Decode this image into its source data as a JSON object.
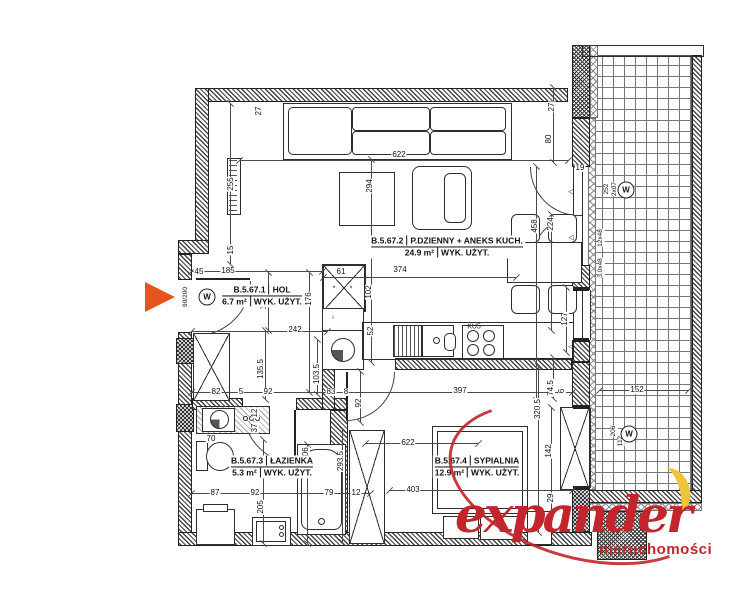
{
  "plan": {
    "rooms": [
      {
        "id": "B.5.67.1",
        "name": "HOL",
        "area": "6.7 m²",
        "usage": "WYK. UŻYT."
      },
      {
        "id": "B.5.67.2",
        "name": "P.DZIENNY + ANEKS KUCH.",
        "area": "24.9 m²",
        "usage": "WYK. UŻYT."
      },
      {
        "id": "B.5.67.3",
        "name": "ŁAZIENKA",
        "area": "5.3 m²",
        "usage": "WYK. UŻYT."
      },
      {
        "id": "B.5.67.4",
        "name": "SYPIALNIA",
        "area": "12.9 m²",
        "usage": "WYK. UŻYT."
      }
    ],
    "dimensions": [
      {
        "t": "27",
        "x": 259,
        "y": 111,
        "r": 1
      },
      {
        "t": "255",
        "x": 231,
        "y": 184,
        "r": 1
      },
      {
        "t": "15",
        "x": 231,
        "y": 250,
        "r": 1
      },
      {
        "t": "622",
        "x": 399,
        "y": 155
      },
      {
        "t": "294",
        "x": 370,
        "y": 186,
        "r": 1
      },
      {
        "t": "374",
        "x": 400,
        "y": 270
      },
      {
        "t": "45",
        "x": 199,
        "y": 272
      },
      {
        "t": "185",
        "x": 228,
        "y": 271
      },
      {
        "t": "104",
        "x": 264,
        "y": 303,
        "r": 1
      },
      {
        "t": "176",
        "x": 309,
        "y": 299,
        "r": 1
      },
      {
        "t": "242",
        "x": 295,
        "y": 330
      },
      {
        "t": "61",
        "x": 341,
        "y": 272
      },
      {
        "t": "102",
        "x": 369,
        "y": 292,
        "r": 1
      },
      {
        "t": "52",
        "x": 371,
        "y": 331,
        "r": 1
      },
      {
        "t": "458",
        "x": 535,
        "y": 226,
        "r": 1
      },
      {
        "t": "224",
        "x": 551,
        "y": 224,
        "r": 1
      },
      {
        "t": "27",
        "x": 552,
        "y": 107,
        "r": 1
      },
      {
        "t": "80",
        "x": 549,
        "y": 139,
        "r": 1
      },
      {
        "t": "19",
        "x": 580,
        "y": 168
      },
      {
        "t": "127",
        "x": 565,
        "y": 319,
        "r": 1
      },
      {
        "t": "92",
        "x": 359,
        "y": 403,
        "r": 1
      },
      {
        "t": "83",
        "x": 331,
        "y": 392
      },
      {
        "t": "8",
        "x": 346,
        "y": 392
      },
      {
        "t": "397",
        "x": 460,
        "y": 391
      },
      {
        "t": "74.5",
        "x": 551,
        "y": 388,
        "r": 1
      },
      {
        "t": "6",
        "x": 562,
        "y": 391,
        "r": 1
      },
      {
        "t": "135.5",
        "x": 261,
        "y": 369,
        "r": 1
      },
      {
        "t": "103.5",
        "x": 317,
        "y": 374,
        "r": 1
      },
      {
        "t": "82",
        "x": 216,
        "y": 392
      },
      {
        "t": "5",
        "x": 241,
        "y": 392
      },
      {
        "t": "92",
        "x": 268,
        "y": 392
      },
      {
        "t": "12",
        "x": 255,
        "y": 413,
        "r": 1
      },
      {
        "t": "37",
        "x": 255,
        "y": 428,
        "r": 1
      },
      {
        "t": "70",
        "x": 211,
        "y": 439
      },
      {
        "t": "206",
        "x": 306,
        "y": 454,
        "r": 1
      },
      {
        "t": "205",
        "x": 261,
        "y": 507,
        "r": 1
      },
      {
        "t": "87",
        "x": 215,
        "y": 493
      },
      {
        "t": "92",
        "x": 255,
        "y": 493
      },
      {
        "t": "79",
        "x": 329,
        "y": 493
      },
      {
        "t": "12",
        "x": 356,
        "y": 493
      },
      {
        "t": "293.5",
        "x": 341,
        "y": 461,
        "r": 1
      },
      {
        "t": "622",
        "x": 408,
        "y": 443
      },
      {
        "t": "403",
        "x": 413,
        "y": 490
      },
      {
        "t": "320.5",
        "x": 538,
        "y": 409,
        "r": 1
      },
      {
        "t": "142",
        "x": 549,
        "y": 451,
        "r": 1
      },
      {
        "t": "29",
        "x": 551,
        "y": 498,
        "r": 1
      },
      {
        "t": "152",
        "x": 637,
        "y": 390
      }
    ],
    "markers": [
      {
        "k": "vt",
        "t": "90/200",
        "x": 186,
        "y": 297
      },
      {
        "k": "circle",
        "t": "W",
        "x": 207,
        "y": 297
      },
      {
        "k": "vt",
        "t": "252",
        "x": 607,
        "y": 189
      },
      {
        "k": "vt",
        "t": "2x07",
        "x": 615,
        "y": 189
      },
      {
        "k": "circle",
        "t": "W",
        "x": 626,
        "y": 190
      },
      {
        "k": "vt",
        "t": "12x48",
        "x": 601,
        "y": 238
      },
      {
        "k": "vt",
        "t": "3.0x48",
        "x": 601,
        "y": 268
      },
      {
        "k": "vt",
        "t": "206",
        "x": 614,
        "y": 431
      },
      {
        "k": "vt",
        "t": "112",
        "x": 621,
        "y": 441
      },
      {
        "k": "circle",
        "t": "W",
        "x": 629,
        "y": 434
      },
      {
        "k": "ht",
        "t": "KU5",
        "x": 474,
        "y": 327
      },
      {
        "k": "ht",
        "t": "*",
        "x": 334,
        "y": 289
      },
      {
        "k": "ht",
        "t": "*",
        "x": 351,
        "y": 289
      },
      {
        "k": "ht",
        "t": "◁",
        "x": 571,
        "y": 192
      },
      {
        "k": "ht",
        "t": "◁",
        "x": 571,
        "y": 238
      },
      {
        "k": "ht",
        "t": "◁",
        "x": 571,
        "y": 347
      },
      {
        "k": "ht",
        "t": "↓",
        "x": 333,
        "y": 317
      }
    ]
  },
  "logo": {
    "brand": "expander",
    "subtitle": "nieruchomości"
  },
  "colors": {
    "logo_red": "#c4242b",
    "logo_yellow": "#eec43a",
    "arrow_orange": "#e8541f",
    "line": "#2e2e2e"
  }
}
